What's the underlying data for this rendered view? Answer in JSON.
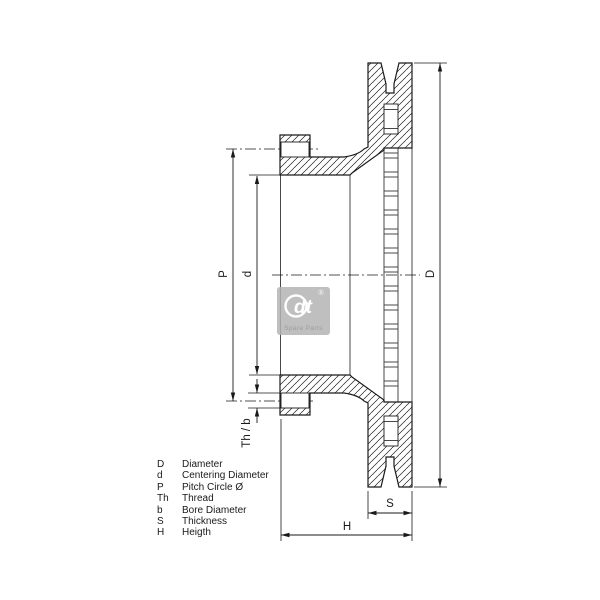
{
  "page": {
    "background": "#ffffff",
    "line_color": "#1a1a1a"
  },
  "drawing": {
    "dimensions": {
      "D": "D",
      "d": "d",
      "P": "P",
      "ThB": "Th / b",
      "S": "S",
      "H": "H"
    },
    "watermark": {
      "brand": "dt",
      "registered": "®",
      "caption": "Spare Parts",
      "color": "#b4b4b4"
    }
  },
  "legend": {
    "rows": [
      {
        "symbol": "D",
        "description": "Diameter"
      },
      {
        "symbol": "d",
        "description": "Centering Diameter"
      },
      {
        "symbol": "P",
        "description": "Pitch Circle Ø"
      },
      {
        "symbol": "Th",
        "description": "Thread"
      },
      {
        "symbol": "b",
        "description": "Bore Diameter"
      },
      {
        "symbol": "S",
        "description": "Thickness"
      },
      {
        "symbol": "H",
        "description": "Heigth"
      }
    ]
  }
}
